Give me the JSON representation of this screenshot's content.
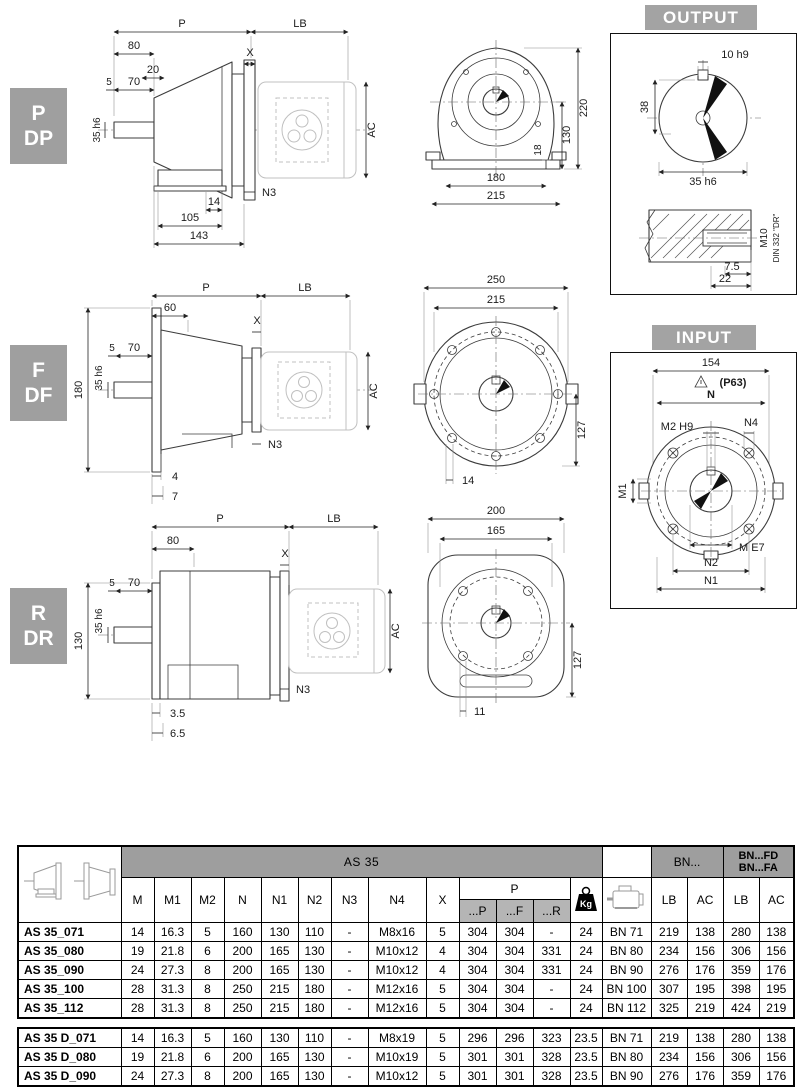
{
  "drawings": {
    "pdp": {
      "tag1": "P",
      "tag2": "DP",
      "side": {
        "P": "P",
        "LB": "LB",
        "d80": "80",
        "d20": "20",
        "X": "X",
        "d5": "5",
        "d70": "70",
        "shaft": "35 h6",
        "AC": "AC",
        "N3": "N3",
        "d14": "14",
        "d105": "105",
        "d143": "143"
      },
      "front": {
        "d220": "220",
        "d130": "130",
        "d18": "18",
        "d180": "180",
        "d215": "215"
      }
    },
    "fdf": {
      "tag1": "F",
      "tag2": "DF",
      "side": {
        "P": "P",
        "LB": "LB",
        "d60": "60",
        "d5": "5",
        "d70": "70",
        "X": "X",
        "shaft": "35 h6",
        "d180": "180",
        "AC": "AC",
        "N3": "N3",
        "d4": "4",
        "d7": "7"
      },
      "front": {
        "d250": "250",
        "d215": "215",
        "d127": "127",
        "d14": "14"
      }
    },
    "rdr": {
      "tag1": "R",
      "tag2": "DR",
      "side": {
        "P": "P",
        "LB": "LB",
        "d80": "80",
        "d5": "5",
        "d70": "70",
        "X": "X",
        "shaft": "35 h6",
        "d130": "130",
        "AC": "AC",
        "N3": "N3",
        "d35": "3.5",
        "d65": "6.5"
      },
      "front": {
        "d200": "200",
        "d165": "165",
        "d127": "127",
        "d11": "11"
      }
    }
  },
  "output_panel": {
    "title": "OUTPUT",
    "d10": "10 h9",
    "d38": "38",
    "d35": "35 h6",
    "d75": "7.5",
    "d22": "22",
    "thread": "M10",
    "din": "DIN 332 \"DR\""
  },
  "input_panel": {
    "title": "INPUT",
    "d154": "154",
    "p63": "(P63)",
    "N": "N",
    "M2": "M2 H9",
    "N4": "N4",
    "M1": "M1",
    "M": "M E7",
    "N2": "N2",
    "N1": "N1"
  },
  "table": {
    "title": "AS 35",
    "dim_headers": [
      "M",
      "M1",
      "M2",
      "N",
      "N1",
      "N2",
      "N3",
      "N4",
      "X"
    ],
    "p_label": "P",
    "p_headers": [
      "...P",
      "...F",
      "...R"
    ],
    "kg_label": "Kg",
    "bn_group": "BN...",
    "bnfd_group": [
      "BN...FD",
      "BN...FA"
    ],
    "lb_ac_headers": [
      "LB",
      "AC",
      "LB",
      "AC"
    ],
    "rows": [
      {
        "name": "AS 35_071",
        "vals": [
          "14",
          "16.3",
          "5",
          "160",
          "130",
          "110",
          "-",
          "M8x16",
          "5",
          "304",
          "304",
          "-",
          "24"
        ],
        "motor": "BN 71",
        "motor_vals": [
          "219",
          "138",
          "280",
          "138"
        ]
      },
      {
        "name": "AS 35_080",
        "vals": [
          "19",
          "21.8",
          "6",
          "200",
          "165",
          "130",
          "-",
          "M10x12",
          "4",
          "304",
          "304",
          "331",
          "24"
        ],
        "motor": "BN 80",
        "motor_vals": [
          "234",
          "156",
          "306",
          "156"
        ]
      },
      {
        "name": "AS 35_090",
        "vals": [
          "24",
          "27.3",
          "8",
          "200",
          "165",
          "130",
          "-",
          "M10x12",
          "4",
          "304",
          "304",
          "331",
          "24"
        ],
        "motor": "BN 90",
        "motor_vals": [
          "276",
          "176",
          "359",
          "176"
        ]
      },
      {
        "name": "AS 35_100",
        "vals": [
          "28",
          "31.3",
          "8",
          "250",
          "215",
          "180",
          "-",
          "M12x16",
          "5",
          "304",
          "304",
          "-",
          "24"
        ],
        "motor": "BN 100",
        "motor_vals": [
          "307",
          "195",
          "398",
          "195"
        ]
      },
      {
        "name": "AS 35_112",
        "vals": [
          "28",
          "31.3",
          "8",
          "250",
          "215",
          "180",
          "-",
          "M12x16",
          "5",
          "304",
          "304",
          "-",
          "24"
        ],
        "motor": "BN 112",
        "motor_vals": [
          "325",
          "219",
          "424",
          "219"
        ]
      }
    ],
    "rows_d": [
      {
        "name": "AS 35 D_071",
        "vals": [
          "14",
          "16.3",
          "5",
          "160",
          "130",
          "110",
          "-",
          "M8x19",
          "5",
          "296",
          "296",
          "323",
          "23.5"
        ],
        "motor": "BN 71",
        "motor_vals": [
          "219",
          "138",
          "280",
          "138"
        ]
      },
      {
        "name": "AS 35 D_080",
        "vals": [
          "19",
          "21.8",
          "6",
          "200",
          "165",
          "130",
          "-",
          "M10x19",
          "5",
          "301",
          "301",
          "328",
          "23.5"
        ],
        "motor": "BN 80",
        "motor_vals": [
          "234",
          "156",
          "306",
          "156"
        ]
      },
      {
        "name": "AS 35 D_090",
        "vals": [
          "24",
          "27.3",
          "8",
          "200",
          "165",
          "130",
          "-",
          "M10x12",
          "5",
          "301",
          "301",
          "328",
          "23.5"
        ],
        "motor": "BN 90",
        "motor_vals": [
          "276",
          "176",
          "359",
          "176"
        ]
      }
    ]
  }
}
